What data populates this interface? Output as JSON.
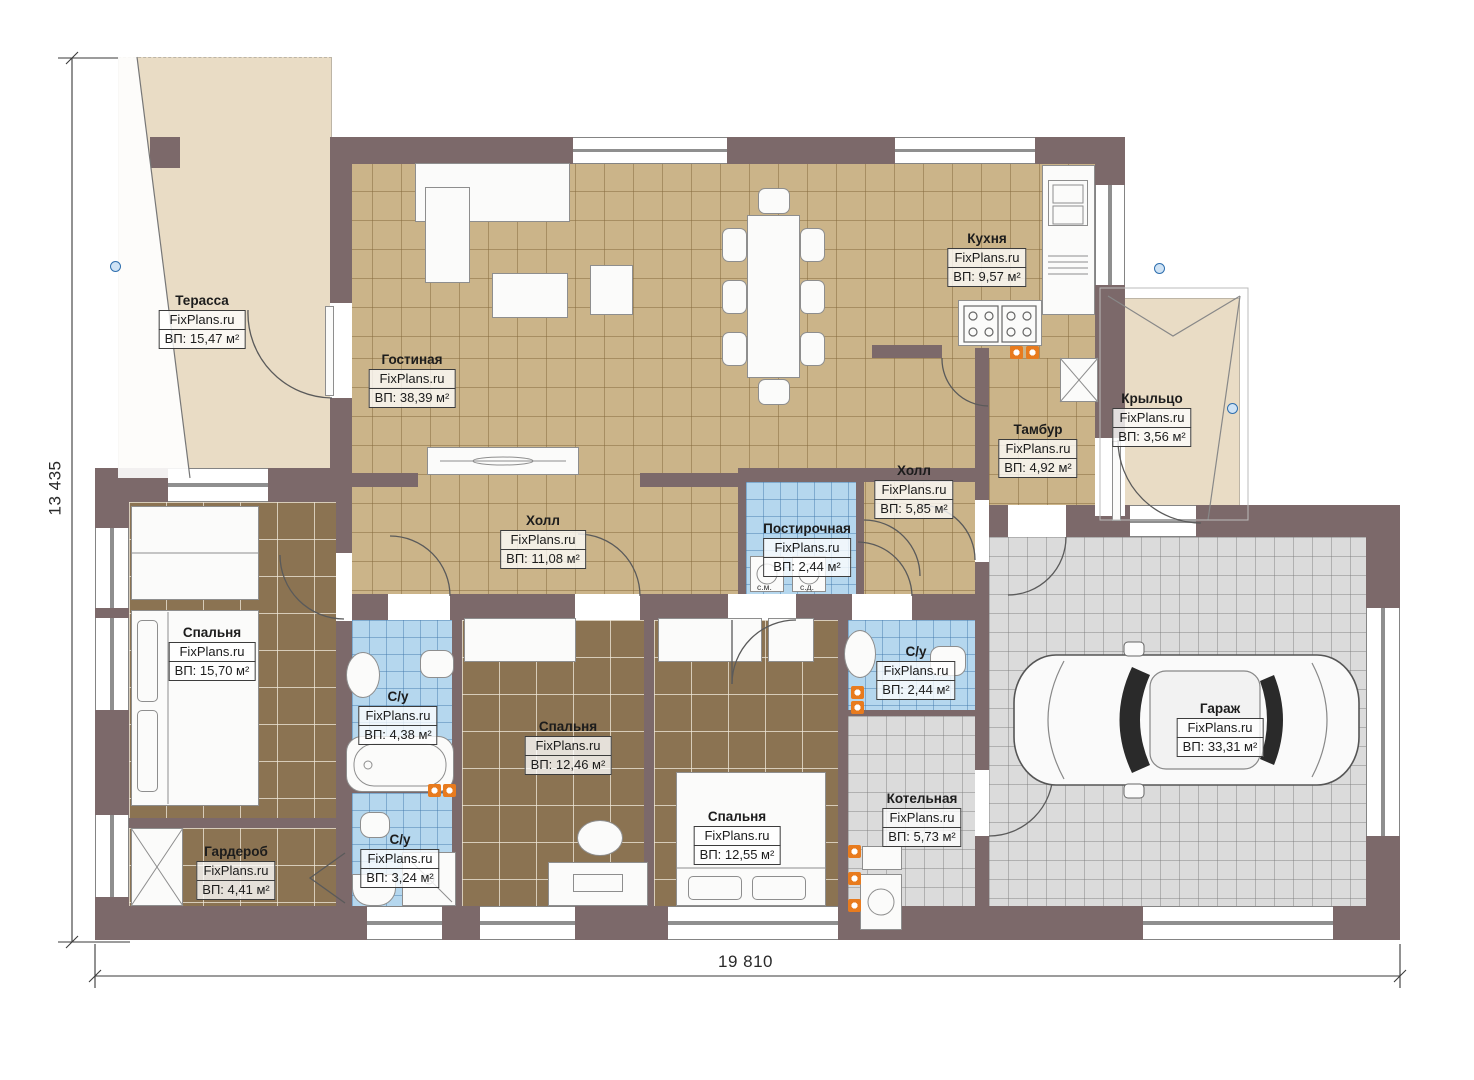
{
  "brand": "FixPlans.ru",
  "dimensions": {
    "width_mm": "19 810",
    "height_mm": "13 435"
  },
  "rooms": [
    {
      "id": "terrace",
      "name": "Терасса",
      "area": "ВП: 15,47 м²"
    },
    {
      "id": "living",
      "name": "Гостиная",
      "area": "ВП: 38,39 м²"
    },
    {
      "id": "kitchen",
      "name": "Кухня",
      "area": "ВП: 9,57 м²"
    },
    {
      "id": "porch",
      "name": "Крыльцо",
      "area": "ВП: 3,56 м²"
    },
    {
      "id": "vestibule",
      "name": "Тамбур",
      "area": "ВП: 4,92 м²"
    },
    {
      "id": "hall-small",
      "name": "Холл",
      "area": "ВП: 5,85 м²"
    },
    {
      "id": "laundry",
      "name": "Постирочная",
      "area": "ВП: 2,44 м²"
    },
    {
      "id": "hall-main",
      "name": "Холл",
      "area": "ВП: 11,08 м²"
    },
    {
      "id": "bedroom-1",
      "name": "Спальня",
      "area": "ВП: 15,70 м²"
    },
    {
      "id": "bath-1",
      "name": "С/у",
      "area": "ВП: 4,38 м²"
    },
    {
      "id": "bedroom-2",
      "name": "Спальня",
      "area": "ВП: 12,46 м²"
    },
    {
      "id": "bedroom-3",
      "name": "Спальня",
      "area": "ВП: 12,55 м²"
    },
    {
      "id": "bath-2",
      "name": "С/у",
      "area": "ВП: 2,44 м²"
    },
    {
      "id": "boiler",
      "name": "Котельная",
      "area": "ВП: 5,73 м²"
    },
    {
      "id": "garage",
      "name": "Гараж",
      "area": "ВП: 33,31 м²"
    },
    {
      "id": "wardrobe",
      "name": "Гардероб",
      "area": "ВП: 4,41 м²"
    },
    {
      "id": "bath-3",
      "name": "С/у",
      "area": "ВП: 3,24 м²"
    }
  ],
  "laundry_appliances": {
    "washer": "с.м.",
    "dryer": "с.д."
  },
  "colors": {
    "wall": "#7c696a",
    "floor_tan": "#cbb489",
    "floor_brown": "#8b7352",
    "floor_blue": "#b5d7ee",
    "floor_gray": "#dbdbdb",
    "outdoor_beige": "#e9dcc5",
    "accent_orange": "#e87b1e",
    "handle_blue": "#2f6fae"
  }
}
